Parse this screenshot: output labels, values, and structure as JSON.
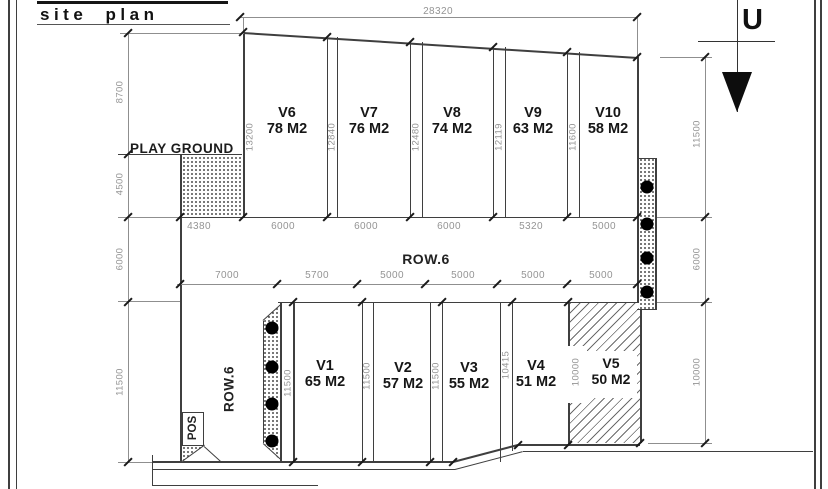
{
  "title": "site plan",
  "north": {
    "label": "U"
  },
  "roads": {
    "horizontal_label": "ROW.6",
    "vertical_label": "ROW.6"
  },
  "playground": {
    "label": "PLAY GROUND"
  },
  "pos": {
    "label": "POS"
  },
  "dims": {
    "overall_top": "28320",
    "left_chain": [
      "8700",
      "4500",
      "6000",
      "11500"
    ],
    "right_chain": [
      "11500",
      "6000",
      "10000"
    ],
    "top_row_widths": [
      "4380",
      "6000",
      "6000",
      "6000",
      "5320",
      "5000"
    ],
    "bottom_row_widths": [
      "7000",
      "5700",
      "5000",
      "5000",
      "5000",
      "5000"
    ],
    "top_row_depths": [
      "13200",
      "12840",
      "12480",
      "12119",
      "11600"
    ],
    "bottom_row_depths": [
      "11500",
      "11500",
      "11500",
      "10415",
      "10000"
    ]
  },
  "plots": {
    "top": [
      {
        "name": "V6",
        "area": "78 M2"
      },
      {
        "name": "V7",
        "area": "76 M2"
      },
      {
        "name": "V8",
        "area": "74 M2"
      },
      {
        "name": "V9",
        "area": "63 M2"
      },
      {
        "name": "V10",
        "area": "58 M2"
      }
    ],
    "bottom": [
      {
        "name": "V1",
        "area": "65 M2"
      },
      {
        "name": "V2",
        "area": "57 M2"
      },
      {
        "name": "V3",
        "area": "55 M2"
      },
      {
        "name": "V4",
        "area": "51 M2"
      },
      {
        "name": "V5",
        "area": "50 M2"
      }
    ]
  }
}
